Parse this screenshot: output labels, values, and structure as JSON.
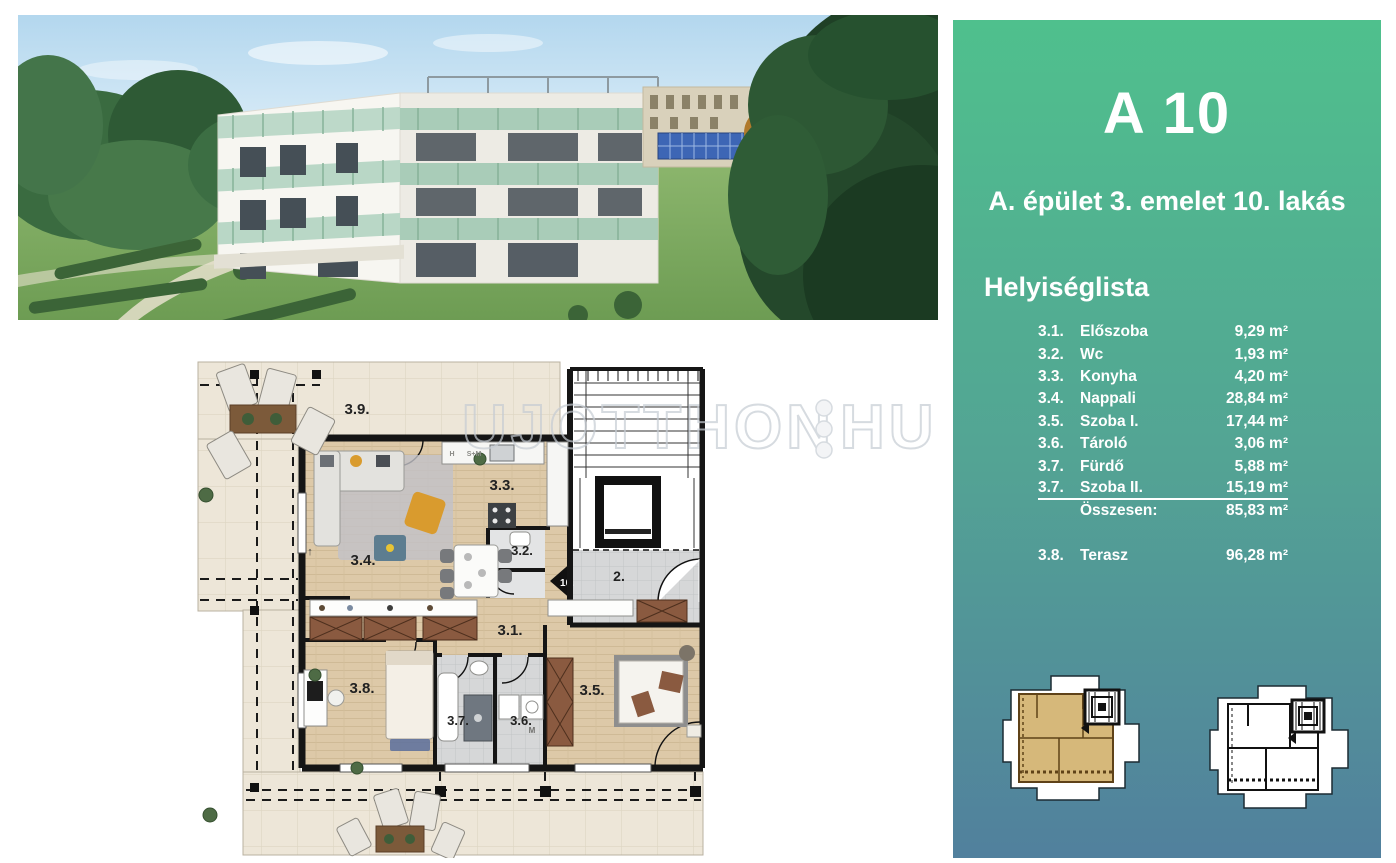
{
  "panel": {
    "title": "A 10",
    "subtitle": "A. épület 3. emelet 10. lakás",
    "list_heading": "Helyiséglista",
    "colors": {
      "gradient_top": "#4FC08D",
      "gradient_bottom": "#51809D",
      "text": "#FFFFFF"
    },
    "rooms": [
      {
        "no": "3.1.",
        "name": "Előszoba",
        "area": "9,29 m²"
      },
      {
        "no": "3.2.",
        "name": "Wc",
        "area": "1,93 m²"
      },
      {
        "no": "3.3.",
        "name": "Konyha",
        "area": "4,20 m²"
      },
      {
        "no": "3.4.",
        "name": "Nappali",
        "area": "28,84 m²"
      },
      {
        "no": "3.5.",
        "name": "Szoba I.",
        "area": "17,44 m²"
      },
      {
        "no": "3.6.",
        "name": "Tároló",
        "area": "3,06 m²"
      },
      {
        "no": "3.7.",
        "name": "Fürdő",
        "area": "5,88 m²"
      },
      {
        "no": "3.7.",
        "name": "Szoba II.",
        "area": "15,19 m²"
      }
    ],
    "total": {
      "label": "Összesen:",
      "area": "85,83 m²"
    },
    "terrace": {
      "no": "3.8.",
      "name": "Terasz",
      "area": "96,28 m²"
    }
  },
  "watermark": {
    "left": "UJOTTHON",
    "right": "HU"
  },
  "plan": {
    "labels": {
      "terrace_39": "3.9.",
      "living_34": "3.4.",
      "kitchen_33": "3.3.",
      "wc_32": "3.2.",
      "hall_31": "3.1.",
      "room_38": "3.8.",
      "bath_37": "3.7.",
      "storage_36": "3.6.",
      "bedroom_35": "3.5.",
      "staircore_2": "2.",
      "unit_entry_10": "10.",
      "kitchen_h": "H",
      "kitchen_sm": "S+M",
      "washer_m": "M",
      "north_arrow": "↑"
    },
    "colors": {
      "terrace_tile": "#EDE6D8",
      "wood_floor": "#DDC9A8",
      "bath_tile": "#D6D7D8",
      "wall": "#151515",
      "wardrobe": "#8A5A40"
    }
  }
}
